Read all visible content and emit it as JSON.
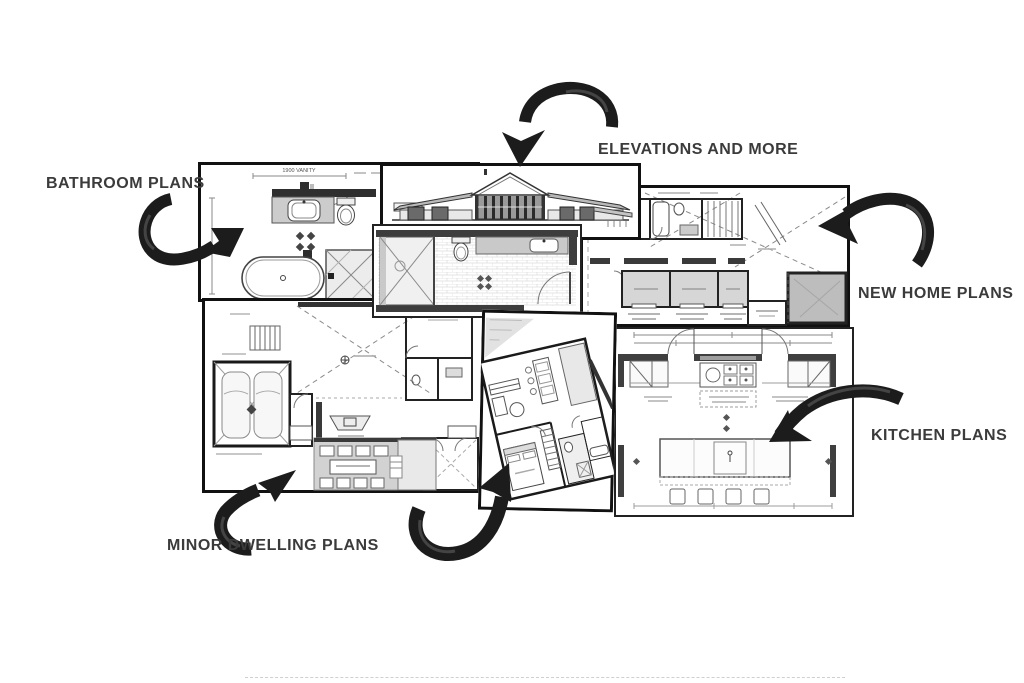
{
  "page": {
    "background": "#ffffff"
  },
  "colors": {
    "page_bg": "#ffffff",
    "label_text": "#3b3b3b",
    "arrow": "#1c1c1c",
    "arrow_sheen": "#4f4f4f",
    "wall_dark": "#3a3a3a",
    "plan_gray": "#d6d6d6"
  },
  "labels": {
    "bathroom": "BATHROOM PLANS",
    "elevations": "ELEVATIONS AND MORE",
    "new_home": "NEW HOME PLANS",
    "kitchen": "KITCHEN PLANS",
    "minor_dwelling": "MINOR DWELLING PLANS"
  },
  "plan_annotations": {
    "bathroom_vanity_dim": "1900 VANITY"
  },
  "panels": [
    {
      "name": "bathroom-plan",
      "depicts": "bathroom floor plan with vanity, toilet, freestanding bath and shower"
    },
    {
      "name": "elevation-drawing",
      "depicts": "house exterior elevation with gable and hip roofs"
    },
    {
      "name": "ensuite-plan",
      "depicts": "narrow tiled ensuite plan with shower, toilet and vanity"
    },
    {
      "name": "new-home-floor-plan",
      "depicts": "whole-house floor plan with bedrooms and roof lines"
    },
    {
      "name": "kitchen-plan",
      "depicts": "kitchen plan with cooktop, island bench and stools"
    },
    {
      "name": "minor-dwelling-floor-plan",
      "depicts": "dwelling plan with double garage, living areas and alfresco"
    },
    {
      "name": "apartment-plan",
      "depicts": "rotated small-dwelling plan with living, kitchen and master bed"
    }
  ],
  "arrows": [
    {
      "name": "bathroom-arrow",
      "points_to": "bathroom-plan"
    },
    {
      "name": "elevations-arrow",
      "points_to": "elevation-drawing"
    },
    {
      "name": "new-home-arrow",
      "points_to": "new-home-floor-plan"
    },
    {
      "name": "kitchen-arrow",
      "points_to": "kitchen-plan"
    },
    {
      "name": "minor-dwelling-arrow",
      "points_to": "minor-dwelling-floor-plan"
    },
    {
      "name": "center-plan-arrow",
      "points_to": "apartment-plan"
    }
  ]
}
